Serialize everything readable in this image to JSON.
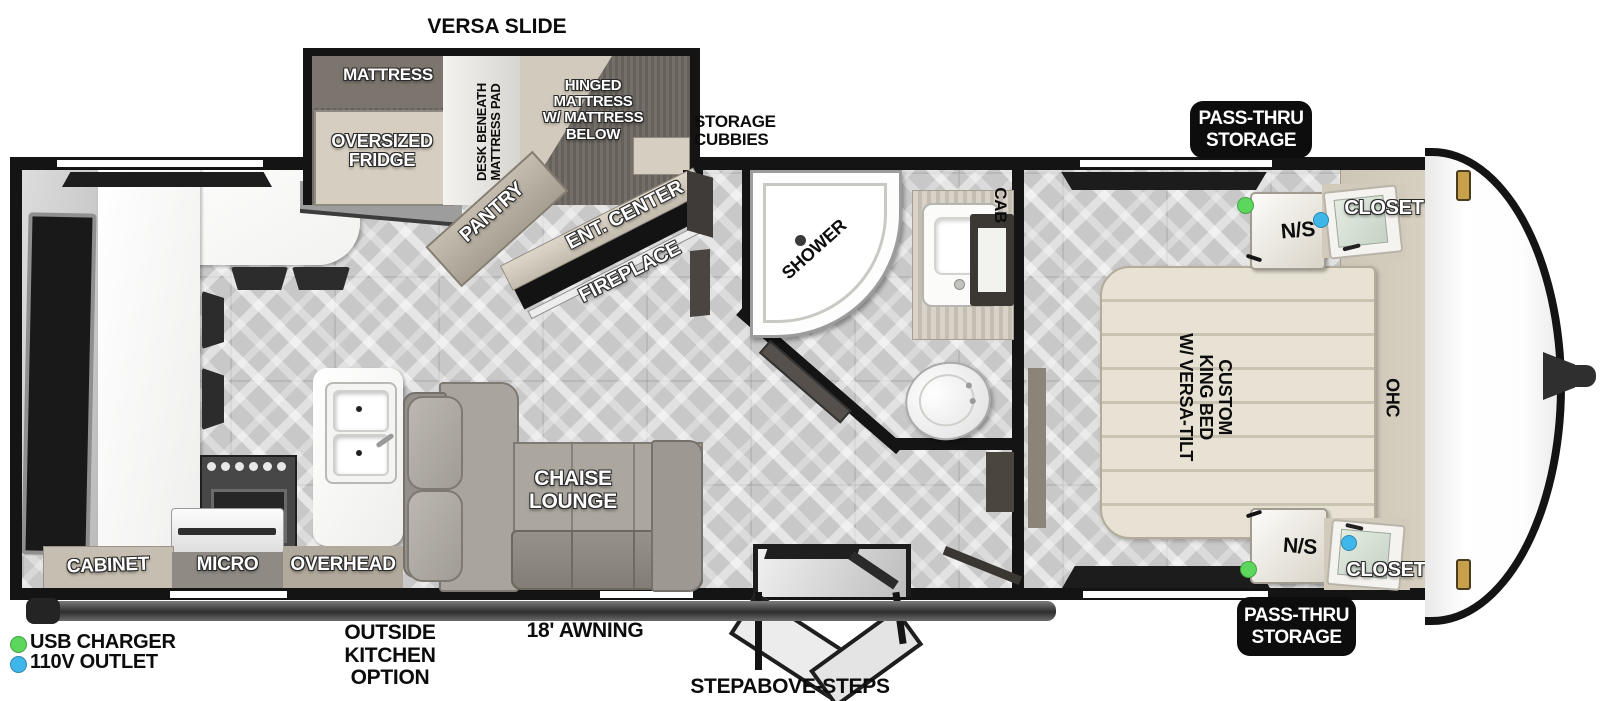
{
  "title": "VERSA SLIDE travel trailer floorplan",
  "slide": {
    "title": "VERSA SLIDE",
    "mattress": "MATTRESS",
    "fridge": "OVERSIZED\nFRIDGE",
    "desk": "DESK BENEATH\nMATTRESS PAD",
    "hinged": "HINGED\nMATTRESS\nW/ MATTRESS\nBELOW"
  },
  "kitchen": {
    "pantry": "PANTRY",
    "cabinet": "CABINET",
    "micro": "MICRO",
    "overhead": "OVERHEAD"
  },
  "living": {
    "ent_center": "ENT. CENTER",
    "fireplace": "FIREPLACE",
    "chaise": "CHAISE\nLOUNGE"
  },
  "bath": {
    "shower": "SHOWER",
    "cab": "CAB"
  },
  "storage": {
    "cubbies": "STORAGE\nCUBBIES",
    "pass_thru_top": "PASS-THRU\nSTORAGE",
    "pass_thru_bottom": "PASS-THRU\nSTORAGE"
  },
  "bedroom": {
    "bed": "CUSTOM\nKING BED\nW/ VERSA-TILT",
    "ohc": "OHC",
    "ns_top": "N/S",
    "ns_bottom": "N/S",
    "closet_top": "CLOSET",
    "closet_bottom": "CLOSET"
  },
  "exterior": {
    "awning": "18' AWNING",
    "outside_kitchen": "OUTSIDE\nKITCHEN\nOPTION",
    "steps": "STEPABOVE-STEPS"
  },
  "legend": {
    "usb_label": "USB CHARGER",
    "outlet_label": "110V OUTLET"
  },
  "colors": {
    "usb_green": "#5cd75c",
    "outlet_blue": "#3fb6ea",
    "wall_black": "#141414",
    "floor_gray": "#c8c8c8",
    "slide_carpet": "#6c6660",
    "cabinet_tan": "#d6cfc1",
    "bed_cream": "#e7e2d3"
  }
}
